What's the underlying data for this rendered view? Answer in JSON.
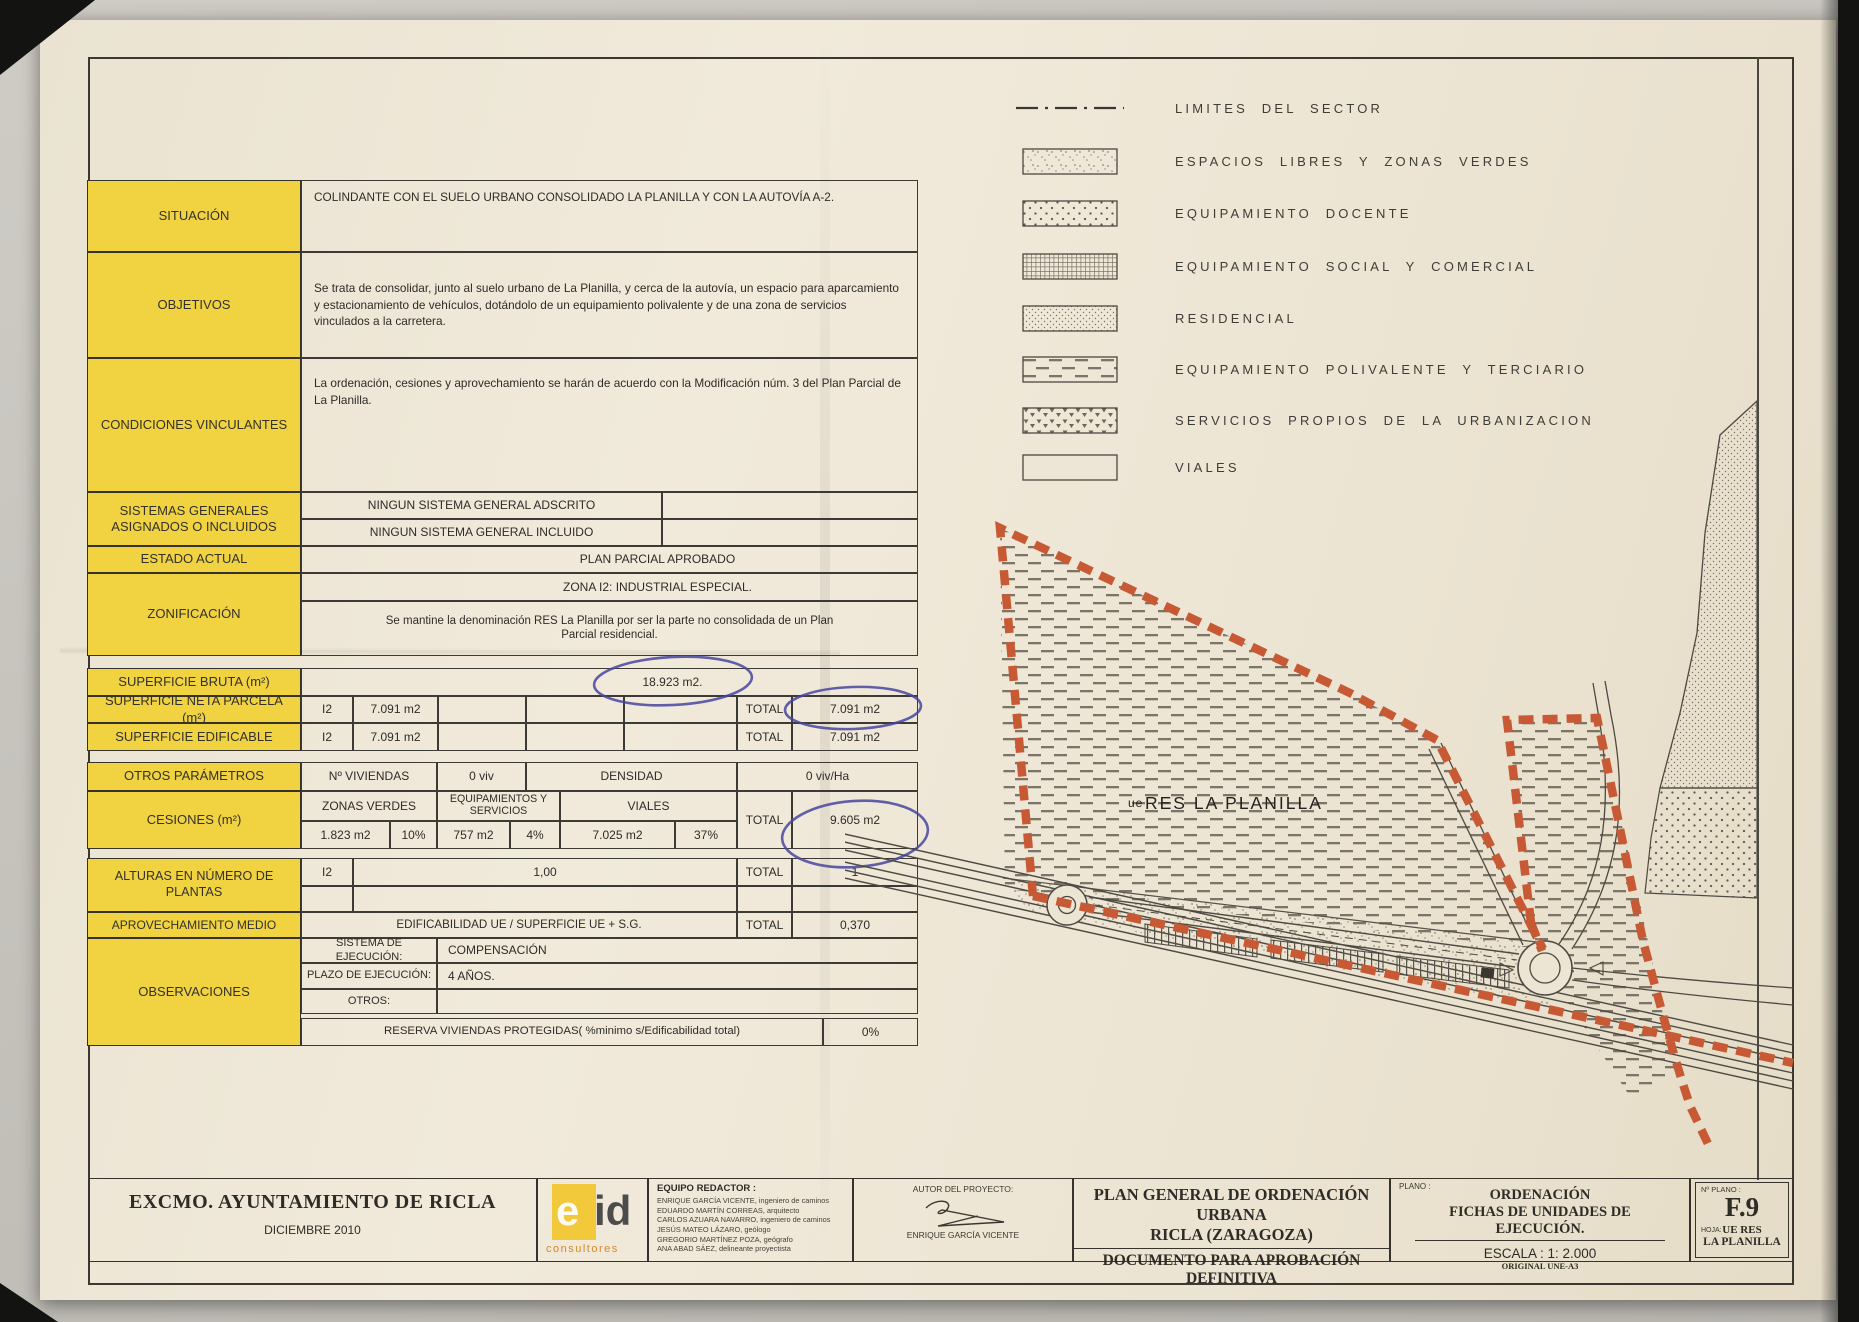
{
  "colors": {
    "highlight_yellow": "#f1d341",
    "sector_boundary_orange": "#c75a34",
    "pen_blue": "#4645a0",
    "paper": "#ece5d4",
    "ink": "#2e2c27"
  },
  "table": {
    "situacion": {
      "label": "SITUACIÓN",
      "text": "COLINDANTE CON EL SUELO URBANO CONSOLIDADO LA PLANILLA Y CON LA AUTOVÍA A-2."
    },
    "objetivos": {
      "label": "OBJETIVOS",
      "text": "Se trata de consolidar, junto al suelo urbano de La Planilla, y cerca de la autovía, un espacio para aparcamiento y estacionamiento de vehículos, dotándolo de un equipamiento polivalente y de una zona de servicios vinculados a la carretera."
    },
    "condiciones": {
      "label": "CONDICIONES VINCULANTES",
      "text": "La ordenación, cesiones y aprovechamiento se harán de acuerdo con la Modificación núm. 3 del Plan Parcial de La Planilla."
    },
    "sistemas": {
      "label": "SISTEMAS GENERALES ASIGNADOS O INCLUIDOS",
      "row1": "NINGUN SISTEMA GENERAL ADSCRITO",
      "row2": "NINGUN SISTEMA GENERAL INCLUIDO"
    },
    "estado": {
      "label": "ESTADO ACTUAL",
      "text": "PLAN PARCIAL APROBADO"
    },
    "zonificacion": {
      "label": "ZONIFICACIÓN",
      "line1": "ZONA I2: INDUSTRIAL ESPECIAL.",
      "line2": "Se mantine la denominación RES La Planilla por ser la parte no consolidada de un Plan Parcial residencial."
    },
    "superficie_bruta": {
      "label": "SUPERFICIE BRUTA (m²)",
      "value": "18.923 m2."
    },
    "superficie_neta": {
      "label": "SUPERFICIE NETA PARCELA (m²)",
      "zone": "I2",
      "zone_value": "7.091 m2",
      "total_label": "TOTAL",
      "total_value": "7.091 m2"
    },
    "superficie_edificable": {
      "label": "SUPERFICIE EDIFICABLE",
      "zone": "I2",
      "zone_value": "7.091 m2",
      "total_label": "TOTAL",
      "total_value": "7.091 m2"
    },
    "otros_parametros": {
      "label": "OTROS PARÁMETROS",
      "col1": "Nº VIVIENDAS",
      "col2": "0 viv",
      "col3": "DENSIDAD",
      "col4": "0 viv/Ha"
    },
    "cesiones": {
      "label": "CESIONES  (m²)",
      "h1": "ZONAS VERDES",
      "h2": "EQUIPAMIENTOS Y SERVICIOS",
      "h3": "VIALES",
      "total_label": "TOTAL",
      "total_value": "9.605 m2",
      "v1": "1.823 m2",
      "p1": "10%",
      "v2": "757 m2",
      "p2": "4%",
      "v3": "7.025 m2",
      "p3": "37%"
    },
    "alturas": {
      "label": "ALTURAS EN NÚMERO DE PLANTAS",
      "zone": "I2",
      "value": "1,00",
      "total_label": "TOTAL",
      "total_value": "1"
    },
    "aprovechamiento": {
      "label": "APROVECHAMIENTO MEDIO",
      "formula": "EDIFICABILIDAD UE / SUPERFICIE UE + S.G.",
      "total_label": "TOTAL",
      "total_value": "0,370"
    },
    "observaciones": {
      "label": "OBSERVACIONES",
      "sistema_label": "SISTEMA DE EJECUCIÓN:",
      "sistema_value": "COMPENSACIÓN",
      "plazo_label": "PLAZO DE EJECUCIÓN:",
      "plazo_value": "4 AÑOS.",
      "otros_label": "OTROS:",
      "otros_value": ""
    },
    "reserva": {
      "label": "RESERVA VIVIENDAS PROTEGIDAS( %minimo s/Edificabilidad total)",
      "value": "0%"
    }
  },
  "legend": {
    "items": [
      {
        "id": "limites",
        "label": "LIMITES DEL SECTOR",
        "pattern": "dash-dot-line"
      },
      {
        "id": "espacios",
        "label": "ESPACIOS LIBRES Y ZONAS VERDES",
        "pattern": "stipple"
      },
      {
        "id": "docente",
        "label": "EQUIPAMIENTO DOCENTE",
        "pattern": "diagonal-dots"
      },
      {
        "id": "social",
        "label": "EQUIPAMIENTO SOCIAL Y COMERCIAL",
        "pattern": "grid"
      },
      {
        "id": "residencial",
        "label": "RESIDENCIAL",
        "pattern": "fine-stipple"
      },
      {
        "id": "polivalente",
        "label": "EQUIPAMIENTO POLIVALENTE Y TERCIARIO",
        "pattern": "dash-rows"
      },
      {
        "id": "servicios",
        "label": "SERVICIOS PROPIOS DE LA URBANIZACION",
        "pattern": "triangles"
      },
      {
        "id": "viales",
        "label": "VIALES",
        "pattern": "blank"
      }
    ]
  },
  "map": {
    "sector_label_prefix": "ue",
    "sector_label": "RES LA PLANILLA"
  },
  "footer": {
    "client": "EXCMO. AYUNTAMIENTO DE RICLA",
    "date": "DICIEMBRE 2010",
    "logo_text": "eid",
    "logo_sub": "consultores",
    "equipo_title": "EQUIPO REDACTOR :",
    "equipo": [
      "ENRIQUE GARCÍA VICENTE, ingeniero de caminos",
      "EDUARDO MARTÍN CORREAS, arquitecto",
      "CARLOS AZUARA NAVARRO, ingeniero de caminos",
      "JESÚS MATEO LÁZARO, geólogo",
      "GREGORIO MARTÍNEZ POZA, geógrafo",
      "ANA ABAD SÁEZ, delineante proyectista"
    ],
    "autor_title": "AUTOR DEL PROYECTO:",
    "autor_name": "ENRIQUE GARCÍA VICENTE",
    "title_line1": "PLAN GENERAL DE ORDENACIÓN URBANA",
    "title_line2": "RICLA (ZARAGOZA)",
    "title_line3": "DOCUMENTO PARA APROBACIÓN DEFINITIVA",
    "plano_label": "PLANO :",
    "plano_line1": "ORDENACIÓN",
    "plano_line2": "FICHAS DE UNIDADES DE EJECUCIÓN.",
    "escala": "ESCALA : 1: 2.000",
    "original": "ORIGINAL UNE-A3",
    "num_plano_label": "Nº PLANO :",
    "num_plano": "F.9",
    "hoja_label": "HOJA:",
    "hoja_line1": "UE  RES",
    "hoja_line2": "LA PLANILLA"
  }
}
